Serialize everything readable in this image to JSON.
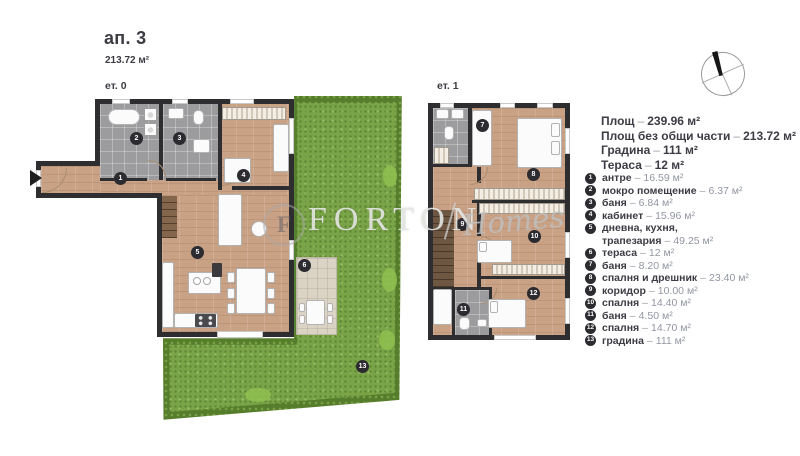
{
  "header": {
    "title": "ап. 3",
    "area": "213.72 м²"
  },
  "floor_labels": {
    "ground": "ет. 0",
    "first": "ет. 1"
  },
  "separator": "–",
  "summary": [
    {
      "label": "Площ",
      "value": "239.96 м²"
    },
    {
      "label": "Площ без общи части",
      "value": "213.72 м²"
    },
    {
      "label": "Градина",
      "value": "111 м²"
    },
    {
      "label": "Тераса",
      "value": "12 м²"
    }
  ],
  "rooms": [
    {
      "num": "1",
      "name": "антре",
      "area": "16.59 м²"
    },
    {
      "num": "2",
      "name": "мокро помещение",
      "area": "6.37 м²"
    },
    {
      "num": "3",
      "name": "баня",
      "area": "6.84 м²"
    },
    {
      "num": "4",
      "name": "кабинет",
      "area": "15.96 м²"
    },
    {
      "num": "5",
      "name": "дневна, кухня, трапезария",
      "area": "49.25 м²"
    },
    {
      "num": "6",
      "name": "тераса",
      "area": "12 м²"
    },
    {
      "num": "7",
      "name": "баня",
      "area": "8.20 м²"
    },
    {
      "num": "8",
      "name": "спалня и дрешник",
      "area": "23.40 м²"
    },
    {
      "num": "9",
      "name": "коридор",
      "area": "10.00 м²"
    },
    {
      "num": "10",
      "name": "спалня",
      "area": "14.40 м²"
    },
    {
      "num": "11",
      "name": "баня",
      "area": "4.50 м²"
    },
    {
      "num": "12",
      "name": "спалня",
      "area": "14.70 м²"
    },
    {
      "num": "13",
      "name": "градина",
      "area": "111 м²"
    }
  ],
  "watermark": {
    "logo_letter": "F",
    "brand": "FORTON",
    "sub": "Homes"
  },
  "colors": {
    "wall": "#2e2e31",
    "wood": "#c9a184",
    "tile": "#9c9c9f",
    "grass": "#79a447",
    "hedge": "#567d2b",
    "terrace": "#dbd4c5",
    "marker": "#2b2b30"
  }
}
